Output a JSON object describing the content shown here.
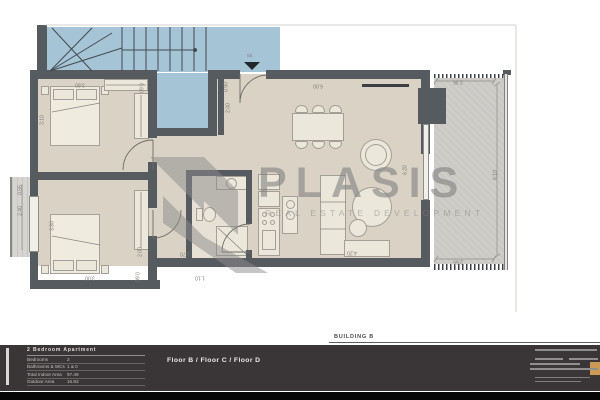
{
  "plan": {
    "entry_label": "5B",
    "watermark": {
      "brand": "PLASIS",
      "tagline": "REAL ESTATE DEVELOPMENT"
    },
    "dimensions": [
      {
        "t": "3.80",
        "x": 80,
        "y": 84,
        "r": 180
      },
      {
        "t": "0.60",
        "x": 140,
        "y": 88,
        "r": 90
      },
      {
        "t": "3.10",
        "x": 43,
        "y": 120,
        "r": -90
      },
      {
        "t": "0.55",
        "x": 21,
        "y": 190,
        "r": -90
      },
      {
        "t": "2.40",
        "x": 21,
        "y": 211,
        "r": -90
      },
      {
        "t": "3.80",
        "x": 53,
        "y": 226,
        "r": -90
      },
      {
        "t": "2.00",
        "x": 141,
        "y": 252,
        "r": -90
      },
      {
        "t": "3.00",
        "x": 90,
        "y": 277,
        "r": 180
      },
      {
        "t": "0.60",
        "x": 136,
        "y": 277,
        "r": 90
      },
      {
        "t": "1.70",
        "x": 185,
        "y": 253,
        "r": 180
      },
      {
        "t": "1.10",
        "x": 200,
        "y": 277,
        "r": 180
      },
      {
        "t": "0.90",
        "x": 227,
        "y": 87,
        "r": -90
      },
      {
        "t": "2.00",
        "x": 229,
        "y": 108,
        "r": -90
      },
      {
        "t": "6.00",
        "x": 318,
        "y": 85,
        "r": 180
      },
      {
        "t": "6.20",
        "x": 406,
        "y": 170,
        "r": -90
      },
      {
        "t": "4.20",
        "x": 352,
        "y": 252,
        "r": 180
      },
      {
        "t": "2.35",
        "x": 458,
        "y": 81,
        "r": 180
      },
      {
        "t": "6.10",
        "x": 496,
        "y": 175,
        "r": -90
      },
      {
        "t": "2.55",
        "x": 458,
        "y": 261,
        "r": 180
      }
    ]
  },
  "title_block": {
    "building_label": "BUILDING B",
    "apartment": {
      "title": "2 Bedroom Apartment",
      "rows": [
        {
          "label": "Bedrooms",
          "value": "2"
        },
        {
          "label": "Bathrooms & WCs",
          "value": "1 & 0"
        },
        {
          "label": "Total Indoor Area",
          "value": "97.49"
        },
        {
          "label": "Outdoor Area",
          "value": "16.83"
        }
      ]
    },
    "floors_label": "Floor B / Floor C / Floor D"
  },
  "colors": {
    "wall": "#565b60",
    "stairwell": "#a5c4d6",
    "floor": "#d9d2c5",
    "balcony": "#cac9c4",
    "watermark": "#8c8c8c",
    "accent": "#cd9a55",
    "titlebar": "#3a3637"
  }
}
